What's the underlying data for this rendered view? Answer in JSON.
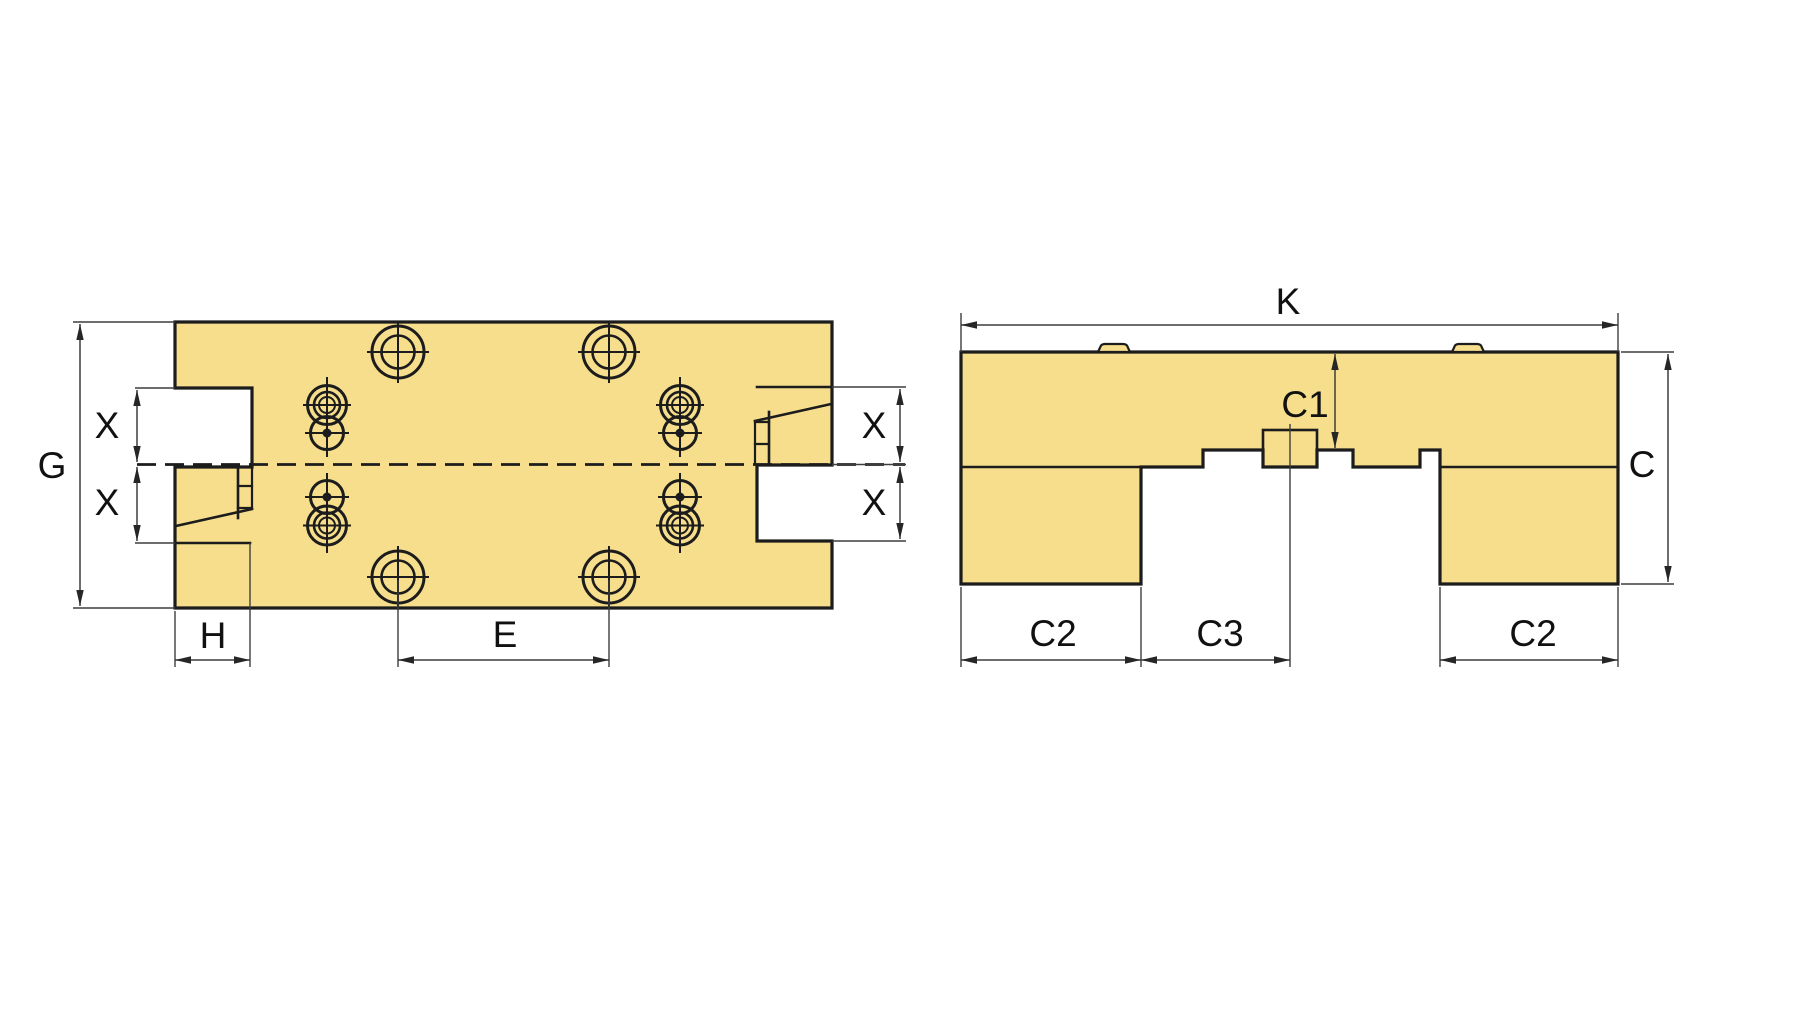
{
  "drawing": {
    "plan_view": {
      "dim_g": "G",
      "dim_x_upper_left": "X",
      "dim_x_lower_left": "X",
      "dim_x_upper_right": "X",
      "dim_x_lower_right": "X",
      "dim_h": "H",
      "dim_e": "E"
    },
    "front_view": {
      "dim_k": "K",
      "dim_c1": "C1",
      "dim_c": "C",
      "dim_c2_left": "C2",
      "dim_c3": "C3",
      "dim_c2_right": "C2"
    }
  },
  "colors": {
    "part_fill": "#F6DE8D",
    "outline": "#1C1C1C",
    "dim_line": "#3D3D3D",
    "background": "#FFFFFF",
    "label_color": "#111111"
  }
}
